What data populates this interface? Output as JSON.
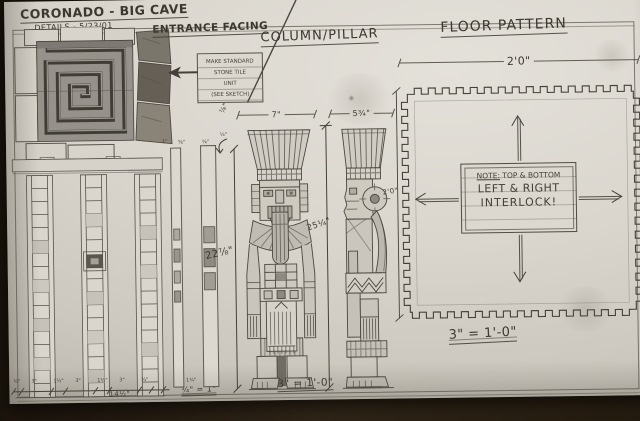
{
  "title_block": {
    "project": "CORONADO - BIG CAVE",
    "details": "DETAILS - 5/23/01",
    "sheet": "SHEET - BC-4"
  },
  "entrance": {
    "label": "ENTRANCE FACING",
    "note_lines": [
      "MAKE STANDARD",
      "STONE TILE",
      "UNIT",
      "(SEE SKETCH)"
    ],
    "dims_row": [
      "¾\"",
      "3\"",
      "1½\"",
      "3\"",
      "1½\"",
      "3\"",
      "¾\""
    ],
    "dim_total": "14½\"",
    "scale_dims": "½\"  1¼\"",
    "scale": "¾\" = 1\""
  },
  "strips": {
    "dims": [
      "1\"",
      "⅝\"",
      "⅝\"",
      "¼\""
    ],
    "callout": "⅞\"",
    "height_dim": "22⅞\""
  },
  "column": {
    "title": "COLUMN/PILLAR",
    "front_width_dim": "7\"",
    "side_width_dim": "5¾\"",
    "height_dim": "25¼\"",
    "scale": "3\" = 1'-0\""
  },
  "floor": {
    "title": "FLOOR PATTERN",
    "width_dim": "2'0\"",
    "height_dim": "2'0\"",
    "note_prefix": "NOTE:",
    "note_line1": "TOP & BOTTOM",
    "note_line2": "LEFT & RIGHT",
    "note_line3": "INTERLOCK!",
    "scale": "3\" = 1'-0\""
  },
  "colors": {
    "paper": "#dbd7cf",
    "pencil": "#433f38",
    "background": "#241b11"
  }
}
